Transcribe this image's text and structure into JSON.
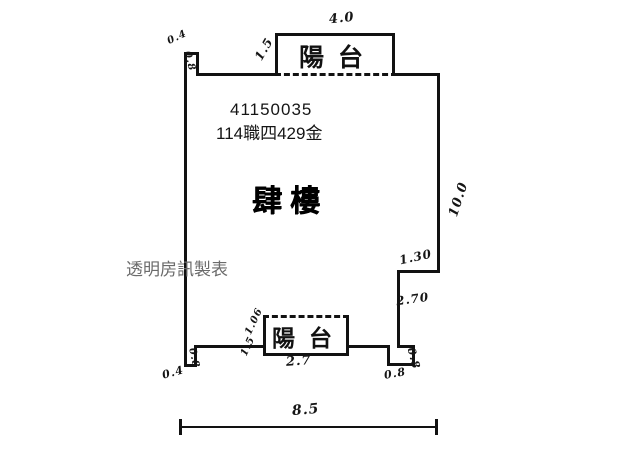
{
  "header": {
    "serial": "41150035",
    "unit": "114職四429金"
  },
  "plan": {
    "floor_name": "肆樓",
    "watermark": "透明房訊製表",
    "balcony_top": {
      "name": "陽台",
      "width": "4.0",
      "depth": "1.5"
    },
    "balcony_bottom": {
      "name": "陽台",
      "width": "2.7",
      "depth_upper": "1.06",
      "depth_lower": "1.5"
    },
    "dimensions": {
      "right_height": "10.0",
      "right_step": "1.30",
      "right_lower": "2.70",
      "total_width": "8.5",
      "tl_notch_w": "0.4",
      "tl_notch_h": "0.8",
      "bl_notch_w": "0.4",
      "bl_notch_h": "0.8",
      "br_notch_w": "0.8",
      "br_notch_h": "0.8"
    }
  },
  "colors": {
    "ink": "#121212",
    "watermark": "#6b6b6b",
    "background": "#ffffff"
  }
}
